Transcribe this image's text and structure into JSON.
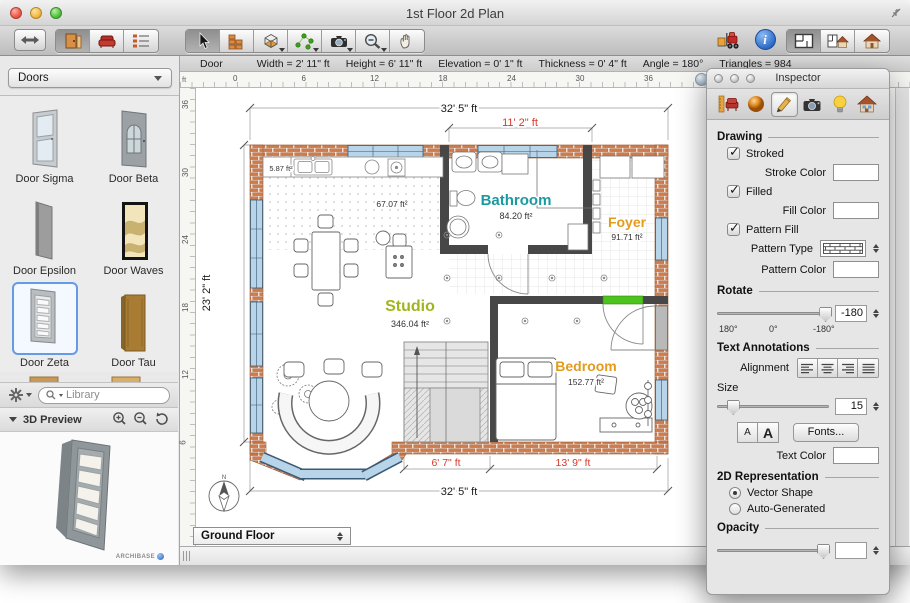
{
  "window": {
    "title": "1st Floor 2d Plan"
  },
  "status_bar": {
    "object": "Door",
    "fields": [
      "Width = 2' 11\" ft",
      "Height = 6' 11\" ft",
      "Elevation = 0' 1\" ft",
      "Thickness = 0' 4\" ft",
      "Angle = 180°",
      "Triangles = 984"
    ]
  },
  "sidebar": {
    "category_value": "Doors",
    "doors": [
      "Door Sigma",
      "Door Beta",
      "Door Epsilon",
      "Door Waves",
      "Door Zeta",
      "Door Tau"
    ],
    "selected_door": "Door Zeta",
    "library_placeholder": "Library",
    "preview_title": "3D Preview",
    "watermark": "ARCHIBASE"
  },
  "rulers": {
    "unit": "ft",
    "h": [
      "0",
      "6",
      "12",
      "18",
      "24",
      "30",
      "36"
    ],
    "v": [
      "36",
      "30",
      "24",
      "18",
      "12",
      "6"
    ]
  },
  "plan": {
    "dim_top": "32' 5\" ft",
    "dim_top_red": "11' 2\" ft",
    "dim_left": "23' 2\" ft",
    "dim_bottom_red_left": "6' 7\" ft",
    "dim_bottom_red_right": "13' 9\" ft",
    "dim_bottom": "32' 5\" ft",
    "rooms": {
      "bathroom": {
        "name": "Bathroom",
        "area": "84.20 ft²",
        "color": "#1a9aa0"
      },
      "foyer": {
        "name": "Foyer",
        "area": "91.71 ft²",
        "color": "#e39b1e"
      },
      "studio": {
        "name": "Studio",
        "area": "346.04 ft²",
        "color": "#a2b51f"
      },
      "bedroom": {
        "name": "Bedroom",
        "area": "152.77 ft²",
        "color": "#e39b1e"
      }
    },
    "area_labels": {
      "kitchen": "67.07 ft²",
      "closet": "5.87 ft²"
    }
  },
  "floor_selector": {
    "value": "Ground Floor"
  },
  "inspector": {
    "title": "Inspector",
    "drawing": {
      "header": "Drawing",
      "stroked": "Stroked",
      "stroke_color": "Stroke Color",
      "filled": "Filled",
      "fill_color": "Fill Color",
      "pattern_fill": "Pattern Fill",
      "pattern_type": "Pattern Type",
      "pattern_color": "Pattern Color"
    },
    "rotate": {
      "header": "Rotate",
      "value": "-180",
      "scale": [
        "180°",
        "0°",
        "-180°"
      ]
    },
    "text_annotations": {
      "header": "Text Annotations",
      "alignment": "Alignment",
      "size": "Size",
      "size_value": "15",
      "small_a": "A",
      "big_a": "A",
      "fonts": "Fonts...",
      "text_color": "Text Color"
    },
    "representation": {
      "header": "2D Representation",
      "vector": "Vector Shape",
      "auto": "Auto-Generated"
    },
    "opacity": {
      "header": "Opacity",
      "value": ""
    },
    "colors": {
      "stroke": "#000000",
      "fill": "#65bb1f",
      "pattern": "#f4a640",
      "text": "#000000"
    }
  }
}
